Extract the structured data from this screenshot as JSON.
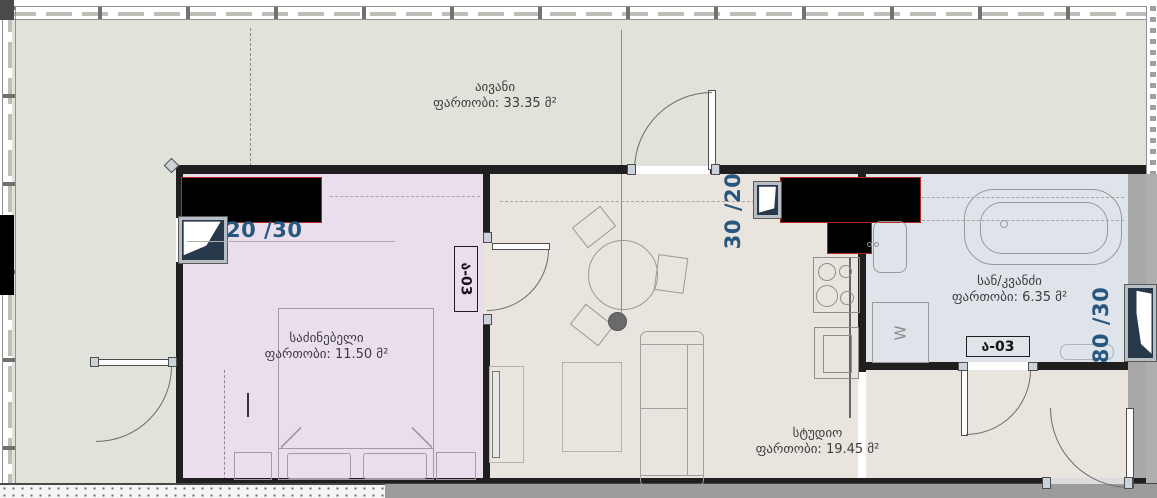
{
  "plan": {
    "rooms": [
      {
        "id": "balcony",
        "name": "აივანი",
        "area": "ფართობი: 33.35 მ²",
        "color": "#dfe3d9"
      },
      {
        "id": "bedroom",
        "name": "საძინებელი",
        "area": "ფართობი: 11.50 მ²",
        "color": "#eadeed"
      },
      {
        "id": "studio",
        "name": "სტუდიო",
        "area": "ფართობი: 19.45 მ²",
        "color": "#e9e5de"
      },
      {
        "id": "bathroom",
        "name": "სან/კვანძი",
        "area": "ფართობი: 6.35 მ²",
        "color": "#dee4ea"
      }
    ],
    "dimensions": [
      {
        "id": "bedroom-window",
        "text": "20 /30"
      },
      {
        "id": "kitchen-window",
        "text": "30 /20"
      },
      {
        "id": "bathroom-window",
        "text": "80 /30"
      }
    ],
    "door_tags": [
      {
        "id": "studio-door",
        "text": "ა-03"
      },
      {
        "id": "bathroom-door",
        "text": "ა-03"
      }
    ],
    "fixtures": {
      "washing_machine_label": "W"
    },
    "colors": {
      "dimension_text": "#27567f",
      "room_label_text": "#3c3c3c",
      "door_tag_text": "#141414",
      "wall_dark": "#1f1f1f",
      "wall_gray": "#9c9c9c",
      "redaction_fill": "#000000",
      "redaction_edge": "#b3261a"
    }
  }
}
